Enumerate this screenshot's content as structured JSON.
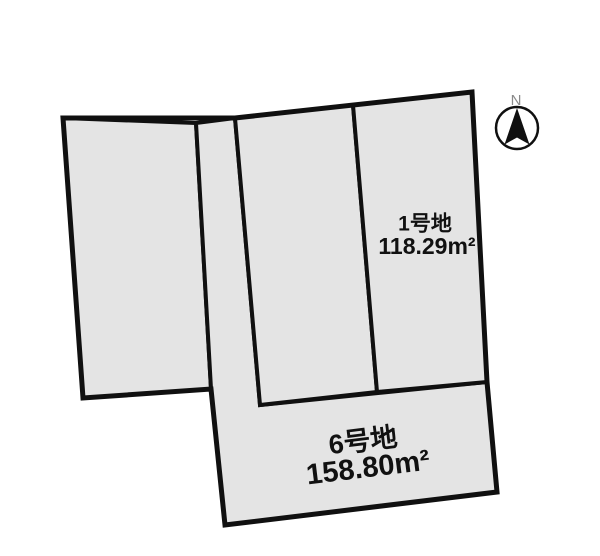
{
  "compass": {
    "label": "N"
  },
  "lots": {
    "lot1": {
      "name": "1号地",
      "area": "118.29m²"
    },
    "lot6": {
      "name": "6号地",
      "area": "158.80m²"
    }
  },
  "map": {
    "background": "#ffffff",
    "parcel_fill": "#e4e4e4",
    "line_color": "#101010",
    "polygons": [
      {
        "name": "parcel-left",
        "points": "63,118 196,123 211,389 83,398"
      },
      {
        "name": "parcel-lot6",
        "points": "196,123 235,118 260,405 487,382 497,492 225,525 211,389"
      },
      {
        "name": "parcel-middle",
        "points": "235,118 353,105 377,392 260,405"
      },
      {
        "name": "parcel-lot1",
        "points": "353,105 472,92 487,382 377,392"
      }
    ],
    "outer_boundary": "63,118 235,118 472,92 487,382 497,492 225,525 211,389 83,398"
  }
}
